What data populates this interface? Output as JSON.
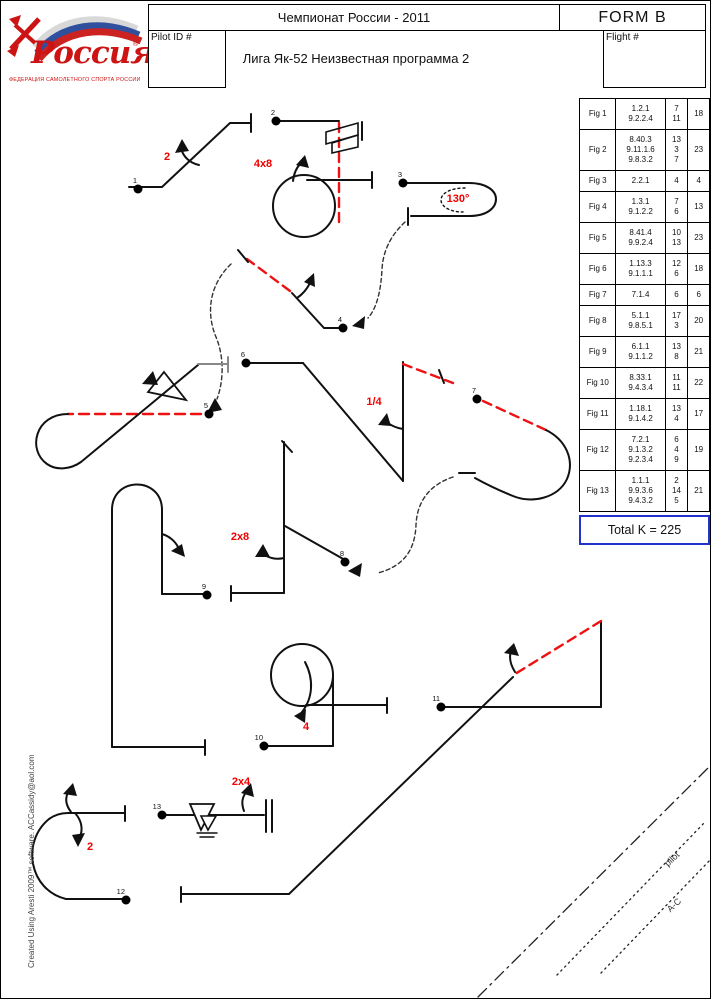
{
  "header": {
    "championship": "Чемпионат России - 2011",
    "form_label": "FORM  B",
    "pilot_id_label": "Pilot ID #",
    "flight_label": "Flight #",
    "program_title": "Лига Як-52  Неизвестная программа 2",
    "logo": {
      "title": "Россия",
      "registered": "®",
      "caption": "ФЕДЕРАЦИЯ САМОЛЕТНОГО СПОРТА РОССИИ"
    }
  },
  "table": {
    "rows": [
      {
        "fig": "Fig 1",
        "catalog": [
          "1.2.1",
          "9.2.2.4"
        ],
        "k": [
          "7",
          "11"
        ],
        "total": "18"
      },
      {
        "fig": "Fig 2",
        "catalog": [
          "8.40.3",
          "9.11.1.6",
          "9.8.3.2"
        ],
        "k": [
          "13",
          "3",
          "7"
        ],
        "total": "23"
      },
      {
        "fig": "Fig 3",
        "catalog": [
          "2.2.1"
        ],
        "k": [
          "4"
        ],
        "total": "4"
      },
      {
        "fig": "Fig 4",
        "catalog": [
          "1.3.1",
          "9.1.2.2"
        ],
        "k": [
          "7",
          "6"
        ],
        "total": "13"
      },
      {
        "fig": "Fig 5",
        "catalog": [
          "8.41.4",
          "9.9.2.4"
        ],
        "k": [
          "10",
          "13"
        ],
        "total": "23"
      },
      {
        "fig": "Fig 6",
        "catalog": [
          "1.13.3",
          "9.1.1.1"
        ],
        "k": [
          "12",
          "6"
        ],
        "total": "18"
      },
      {
        "fig": "Fig 7",
        "catalog": [
          "7.1.4"
        ],
        "k": [
          "6"
        ],
        "total": "6"
      },
      {
        "fig": "Fig 8",
        "catalog": [
          "5.1.1",
          "9.8.5.1"
        ],
        "k": [
          "17",
          "3"
        ],
        "total": "20"
      },
      {
        "fig": "Fig 9",
        "catalog": [
          "6.1.1",
          "9.1.1.2"
        ],
        "k": [
          "13",
          "8"
        ],
        "total": "21"
      },
      {
        "fig": "Fig 10",
        "catalog": [
          "8.33.1",
          "9.4.3.4"
        ],
        "k": [
          "11",
          "11"
        ],
        "total": "22"
      },
      {
        "fig": "Fig 11",
        "catalog": [
          "1.18.1",
          "9.1.4.2"
        ],
        "k": [
          "13",
          "4"
        ],
        "total": "17"
      },
      {
        "fig": "Fig 12",
        "catalog": [
          "7.2.1",
          "9.1.3.2",
          "9.2.3.4"
        ],
        "k": [
          "6",
          "4",
          "9"
        ],
        "total": "19"
      },
      {
        "fig": "Fig 13",
        "catalog": [
          "1.1.1",
          "9.9.3.6",
          "9.4.3.2"
        ],
        "k": [
          "2",
          "14",
          "5"
        ],
        "total": "21"
      }
    ],
    "total_label": "Total K = 225"
  },
  "drawing": {
    "points": [
      {
        "label": "1",
        "x": 137,
        "y": 188
      },
      {
        "label": "2",
        "x": 275,
        "y": 120
      },
      {
        "label": "3",
        "x": 402,
        "y": 182
      },
      {
        "label": "4",
        "x": 342,
        "y": 327
      },
      {
        "label": "5",
        "x": 208,
        "y": 413
      },
      {
        "label": "6",
        "x": 245,
        "y": 362
      },
      {
        "label": "7",
        "x": 476,
        "y": 398
      },
      {
        "label": "8",
        "x": 344,
        "y": 561
      },
      {
        "label": "9",
        "x": 206,
        "y": 594
      },
      {
        "label": "10",
        "x": 263,
        "y": 745
      },
      {
        "label": "11",
        "x": 440,
        "y": 706
      },
      {
        "label": "12",
        "x": 125,
        "y": 899
      },
      {
        "label": "13",
        "x": 161,
        "y": 814
      }
    ],
    "annotations": [
      {
        "text": "2",
        "x": 166,
        "y": 156
      },
      {
        "text": "4x8",
        "x": 262,
        "y": 163
      },
      {
        "text": "130°",
        "x": 457,
        "y": 198
      },
      {
        "text": "1/4",
        "x": 373,
        "y": 401
      },
      {
        "text": "2x8",
        "x": 239,
        "y": 536
      },
      {
        "text": "4",
        "x": 305,
        "y": 726
      },
      {
        "text": "2",
        "x": 89,
        "y": 846
      },
      {
        "text": "2x4",
        "x": 240,
        "y": 781
      }
    ],
    "markers": [
      {
        "text": "pilot",
        "x": 671,
        "y": 858
      },
      {
        "text": "A-C",
        "x": 673,
        "y": 904
      }
    ]
  },
  "credit": "Created Using Aresti 2009™ software.  ACCassidy@aol.com",
  "colors": {
    "annotation_red": "#f00000",
    "dashed_red": "#ee1111",
    "total_border_blue": "#2233cc"
  }
}
